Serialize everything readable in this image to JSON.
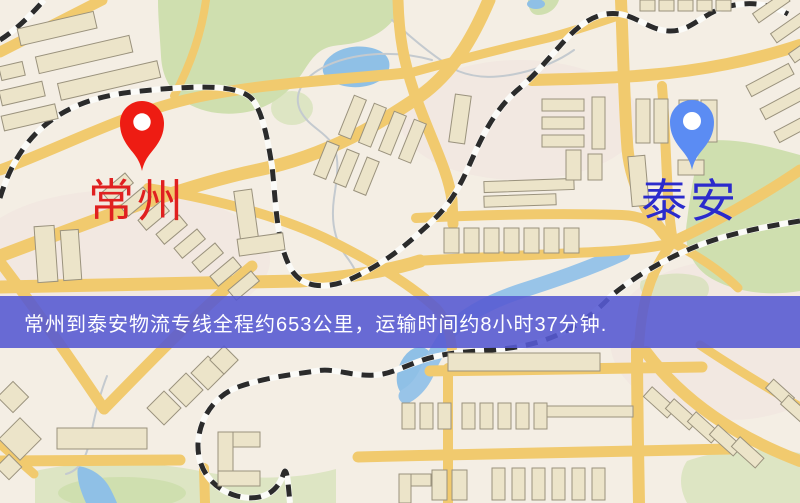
{
  "map": {
    "origin": {
      "label": "常州",
      "pin_color": "#ee1c13",
      "label_color": "#e02020"
    },
    "destination": {
      "label": "泰安",
      "pin_color": "#5b8cf3",
      "label_color": "#2b2bcc"
    },
    "palette": {
      "background": "#f4eee4",
      "road": "#f1ca6e",
      "water": "#8fc0e6",
      "park": "#cfdfaf",
      "building_fill": "#ece4c9",
      "building_stroke": "#9a927d",
      "railway_dash": "#2b2b2b",
      "railway_base": "#fbfbf8",
      "stream": "#c4cacf"
    }
  },
  "banner": {
    "text": "常州到泰安物流专线全程约653公里，运输时间约8小时37分钟.",
    "background_color": "#5a5ed2",
    "text_color": "#ffffff"
  }
}
